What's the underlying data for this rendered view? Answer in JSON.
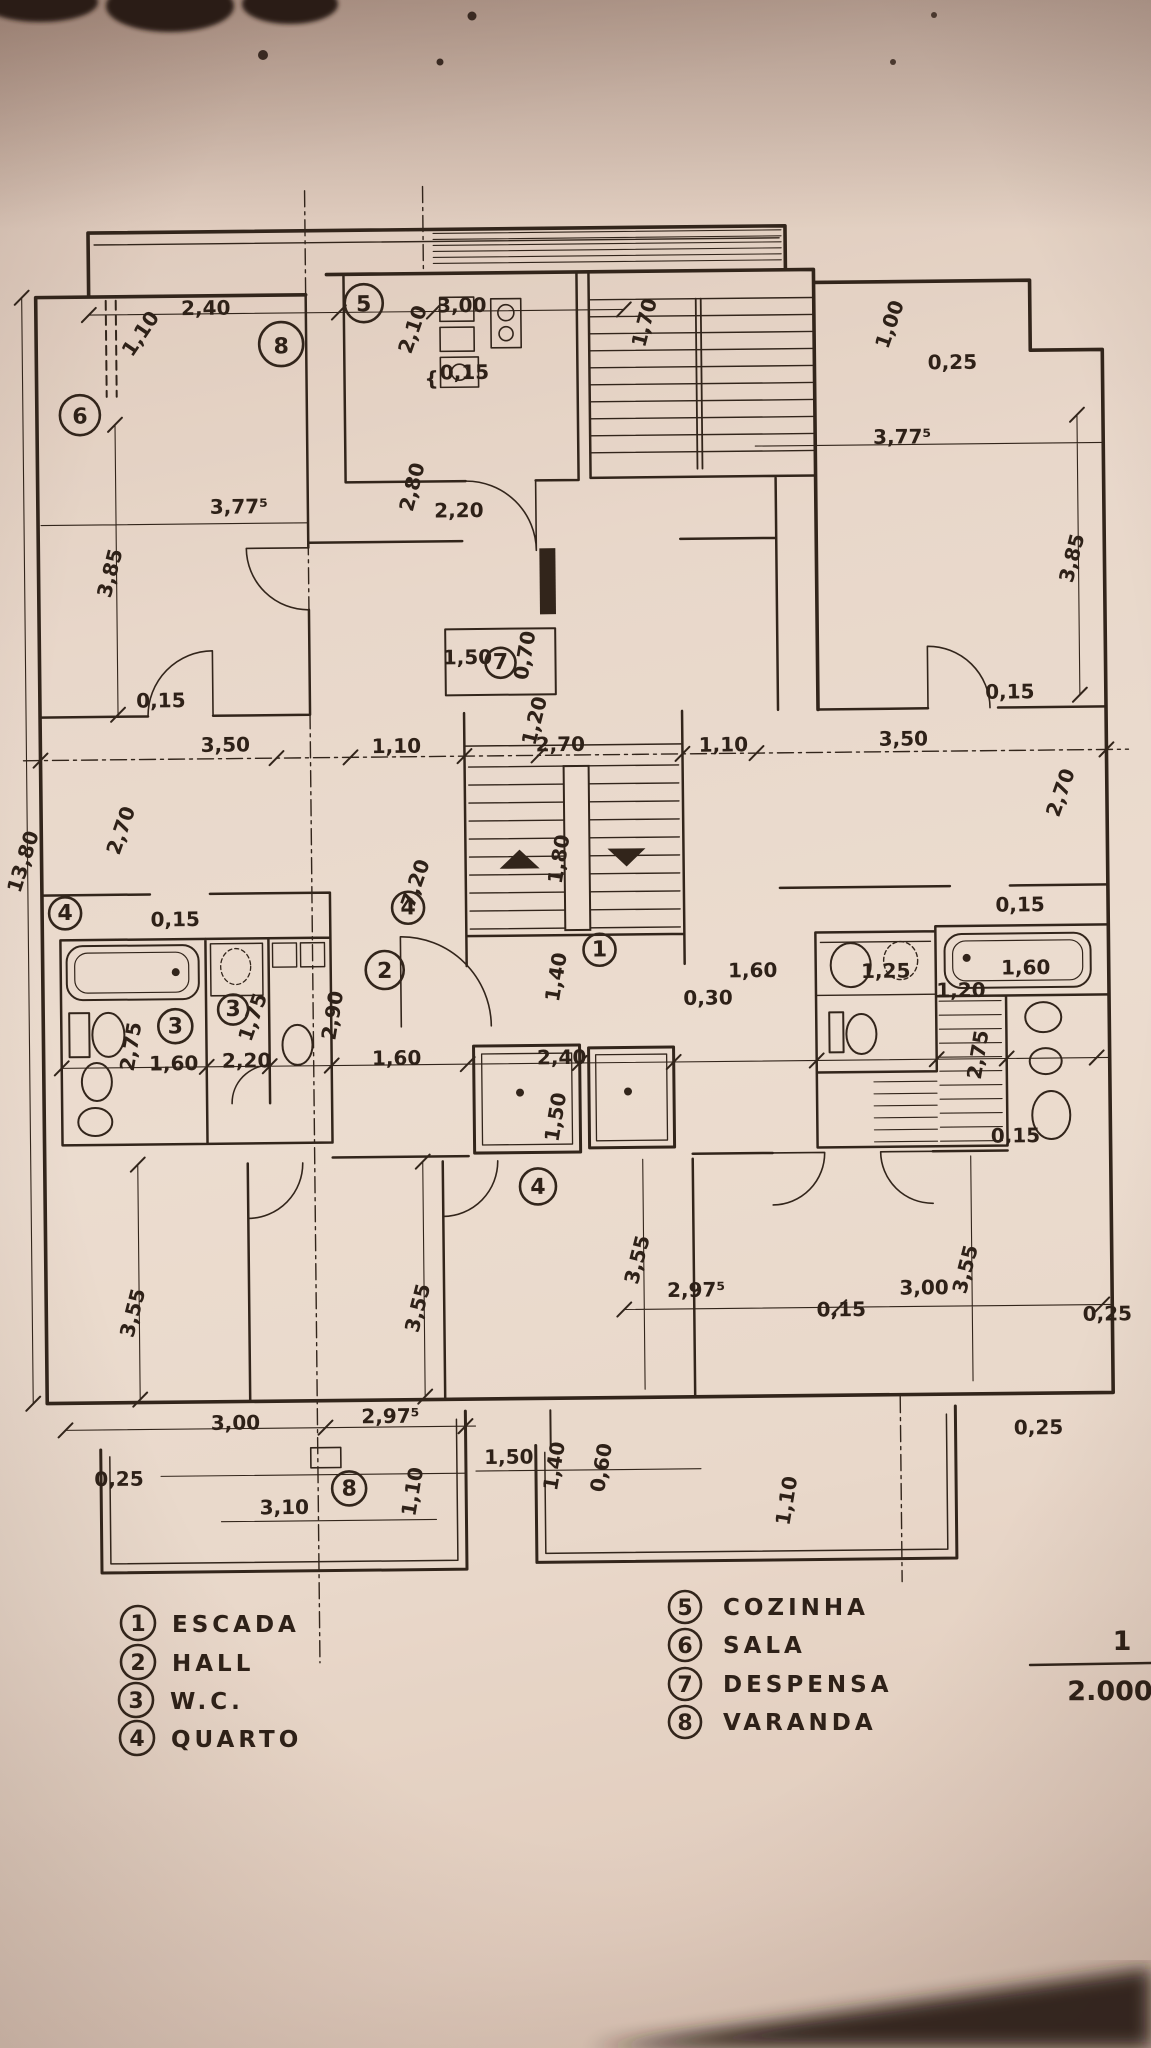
{
  "colors": {
    "ink": "#32251b",
    "paper": "#ecdccf",
    "shadow": "#2a1c16"
  },
  "legend_left": [
    {
      "num": "1",
      "label": "ESCADA"
    },
    {
      "num": "2",
      "label": "HALL"
    },
    {
      "num": "3",
      "label": "W.C."
    },
    {
      "num": "4",
      "label": "QUARTO"
    }
  ],
  "legend_right": [
    {
      "num": "5",
      "label": "COZINHA"
    },
    {
      "num": "6",
      "label": "SALA"
    },
    {
      "num": "7",
      "label": "DESPENSA"
    },
    {
      "num": "8",
      "label": "VARANDA"
    }
  ],
  "scale": {
    "numerator": "1",
    "denominator": "2.000"
  },
  "room_markers": [
    {
      "n": "6",
      "x": 85,
      "y": 410,
      "r": 20
    },
    {
      "n": "8",
      "x": 287,
      "y": 341,
      "r": 22
    },
    {
      "n": "5",
      "x": 370,
      "y": 301,
      "r": 19
    },
    {
      "n": "7",
      "x": 503,
      "y": 662,
      "r": 15
    },
    {
      "n": "1",
      "x": 599,
      "y": 950,
      "r": 16
    },
    {
      "n": "2",
      "x": 384,
      "y": 968,
      "r": 19
    },
    {
      "n": "3",
      "x": 174,
      "y": 1022,
      "r": 17
    },
    {
      "n": "3",
      "x": 232,
      "y": 1006,
      "r": 15
    },
    {
      "n": "4",
      "x": 65,
      "y": 908,
      "r": 16
    },
    {
      "n": "4",
      "x": 408,
      "y": 906,
      "r": 16
    },
    {
      "n": "4",
      "x": 535,
      "y": 1186,
      "r": 18
    },
    {
      "n": "8",
      "x": 343,
      "y": 1486,
      "r": 17
    }
  ],
  "dim_labels": [
    {
      "t": "2,40",
      "x": 212,
      "y": 311,
      "r": 0
    },
    {
      "t": "1,10",
      "x": 152,
      "y": 333,
      "r": -55
    },
    {
      "t": "3,00",
      "x": 468,
      "y": 311,
      "r": 0
    },
    {
      "t": "2,10",
      "x": 425,
      "y": 330,
      "r": -70
    },
    {
      "t": "1,70",
      "x": 657,
      "y": 325,
      "r": -75
    },
    {
      "t": "1,00",
      "x": 902,
      "y": 330,
      "r": -70
    },
    {
      "t": "0,25",
      "x": 958,
      "y": 373,
      "r": 0
    },
    {
      "t": "{",
      "x": 437,
      "y": 384,
      "r": 0
    },
    {
      "t": "0,15",
      "x": 470,
      "y": 378,
      "r": 0
    },
    {
      "t": "2,80",
      "x": 423,
      "y": 487,
      "r": -75
    },
    {
      "t": "2,20",
      "x": 463,
      "y": 516,
      "r": 0
    },
    {
      "t": "3,77⁵",
      "x": 243,
      "y": 510,
      "r": 0
    },
    {
      "t": "3,85",
      "x": 120,
      "y": 570,
      "r": -75
    },
    {
      "t": "3,77⁵",
      "x": 907,
      "y": 447,
      "r": 0
    },
    {
      "t": "3,85",
      "x": 1082,
      "y": 565,
      "r": -75
    },
    {
      "t": "1,50",
      "x": 470,
      "y": 663,
      "r": 0
    },
    {
      "t": "0,70",
      "x": 534,
      "y": 656,
      "r": -80
    },
    {
      "t": "0,15",
      "x": 163,
      "y": 703,
      "r": 0
    },
    {
      "t": "3,50",
      "x": 227,
      "y": 748,
      "r": 0
    },
    {
      "t": "1,10",
      "x": 398,
      "y": 751,
      "r": 0
    },
    {
      "t": "1,20",
      "x": 543,
      "y": 722,
      "r": -75
    },
    {
      "t": "2,70",
      "x": 562,
      "y": 751,
      "r": 0
    },
    {
      "t": "1,10",
      "x": 725,
      "y": 753,
      "r": 0
    },
    {
      "t": "3,50",
      "x": 905,
      "y": 749,
      "r": 0
    },
    {
      "t": "0,15",
      "x": 1012,
      "y": 703,
      "r": 0
    },
    {
      "t": "2,70",
      "x": 128,
      "y": 828,
      "r": -70
    },
    {
      "t": "13,80",
      "x": 30,
      "y": 858,
      "r": -72
    },
    {
      "t": "2,70",
      "x": 1068,
      "y": 800,
      "r": -70
    },
    {
      "t": "7,20",
      "x": 422,
      "y": 884,
      "r": -70
    },
    {
      "t": "1,80",
      "x": 566,
      "y": 860,
      "r": -80
    },
    {
      "t": "0,15",
      "x": 175,
      "y": 922,
      "r": 0
    },
    {
      "t": "0,15",
      "x": 1020,
      "y": 916,
      "r": 0
    },
    {
      "t": "2,75",
      "x": 136,
      "y": 1043,
      "r": -80
    },
    {
      "t": "1,60",
      "x": 172,
      "y": 1066,
      "r": 0
    },
    {
      "t": "2,20",
      "x": 245,
      "y": 1064,
      "r": 0
    },
    {
      "t": "1,75",
      "x": 258,
      "y": 1016,
      "r": -70
    },
    {
      "t": "2,90",
      "x": 338,
      "y": 1014,
      "r": -80
    },
    {
      "t": "1,60",
      "x": 395,
      "y": 1063,
      "r": 0
    },
    {
      "t": "2,40",
      "x": 560,
      "y": 1064,
      "r": 0
    },
    {
      "t": "1,40",
      "x": 562,
      "y": 978,
      "r": -80
    },
    {
      "t": "1,50",
      "x": 560,
      "y": 1118,
      "r": -80
    },
    {
      "t": "1,60",
      "x": 752,
      "y": 979,
      "r": 0
    },
    {
      "t": "0,30",
      "x": 707,
      "y": 1006,
      "r": 0
    },
    {
      "t": "1,25",
      "x": 885,
      "y": 981,
      "r": 0
    },
    {
      "t": "1,20",
      "x": 960,
      "y": 1001,
      "r": 0
    },
    {
      "t": "1,60",
      "x": 1025,
      "y": 979,
      "r": 0
    },
    {
      "t": "2,75",
      "x": 983,
      "y": 1060,
      "r": -80
    },
    {
      "t": "0,15",
      "x": 1013,
      "y": 1147,
      "r": 0
    },
    {
      "t": "3,55",
      "x": 135,
      "y": 1310,
      "r": -75
    },
    {
      "t": "3,55",
      "x": 420,
      "y": 1308,
      "r": -75
    },
    {
      "t": "3,55",
      "x": 640,
      "y": 1262,
      "r": -75
    },
    {
      "t": "2,97⁵",
      "x": 692,
      "y": 1298,
      "r": 0
    },
    {
      "t": "3,00",
      "x": 920,
      "y": 1298,
      "r": 0
    },
    {
      "t": "3,55",
      "x": 968,
      "y": 1275,
      "r": -75
    },
    {
      "t": "0,15",
      "x": 837,
      "y": 1319,
      "r": 0
    },
    {
      "t": "0,25",
      "x": 1103,
      "y": 1326,
      "r": 0
    },
    {
      "t": "3,00",
      "x": 230,
      "y": 1426,
      "r": 0
    },
    {
      "t": "2,97⁵",
      "x": 385,
      "y": 1421,
      "r": 0
    },
    {
      "t": "0,25",
      "x": 113,
      "y": 1481,
      "r": 0
    },
    {
      "t": "3,10",
      "x": 278,
      "y": 1511,
      "r": 0
    },
    {
      "t": "1,10",
      "x": 413,
      "y": 1491,
      "r": -80
    },
    {
      "t": "1,50",
      "x": 503,
      "y": 1463,
      "r": 0
    },
    {
      "t": "1,40",
      "x": 555,
      "y": 1467,
      "r": -80
    },
    {
      "t": "0,60",
      "x": 602,
      "y": 1469,
      "r": -80
    },
    {
      "t": "1,10",
      "x": 787,
      "y": 1504,
      "r": -80
    },
    {
      "t": "0,25",
      "x": 1033,
      "y": 1439,
      "r": 0
    }
  ]
}
